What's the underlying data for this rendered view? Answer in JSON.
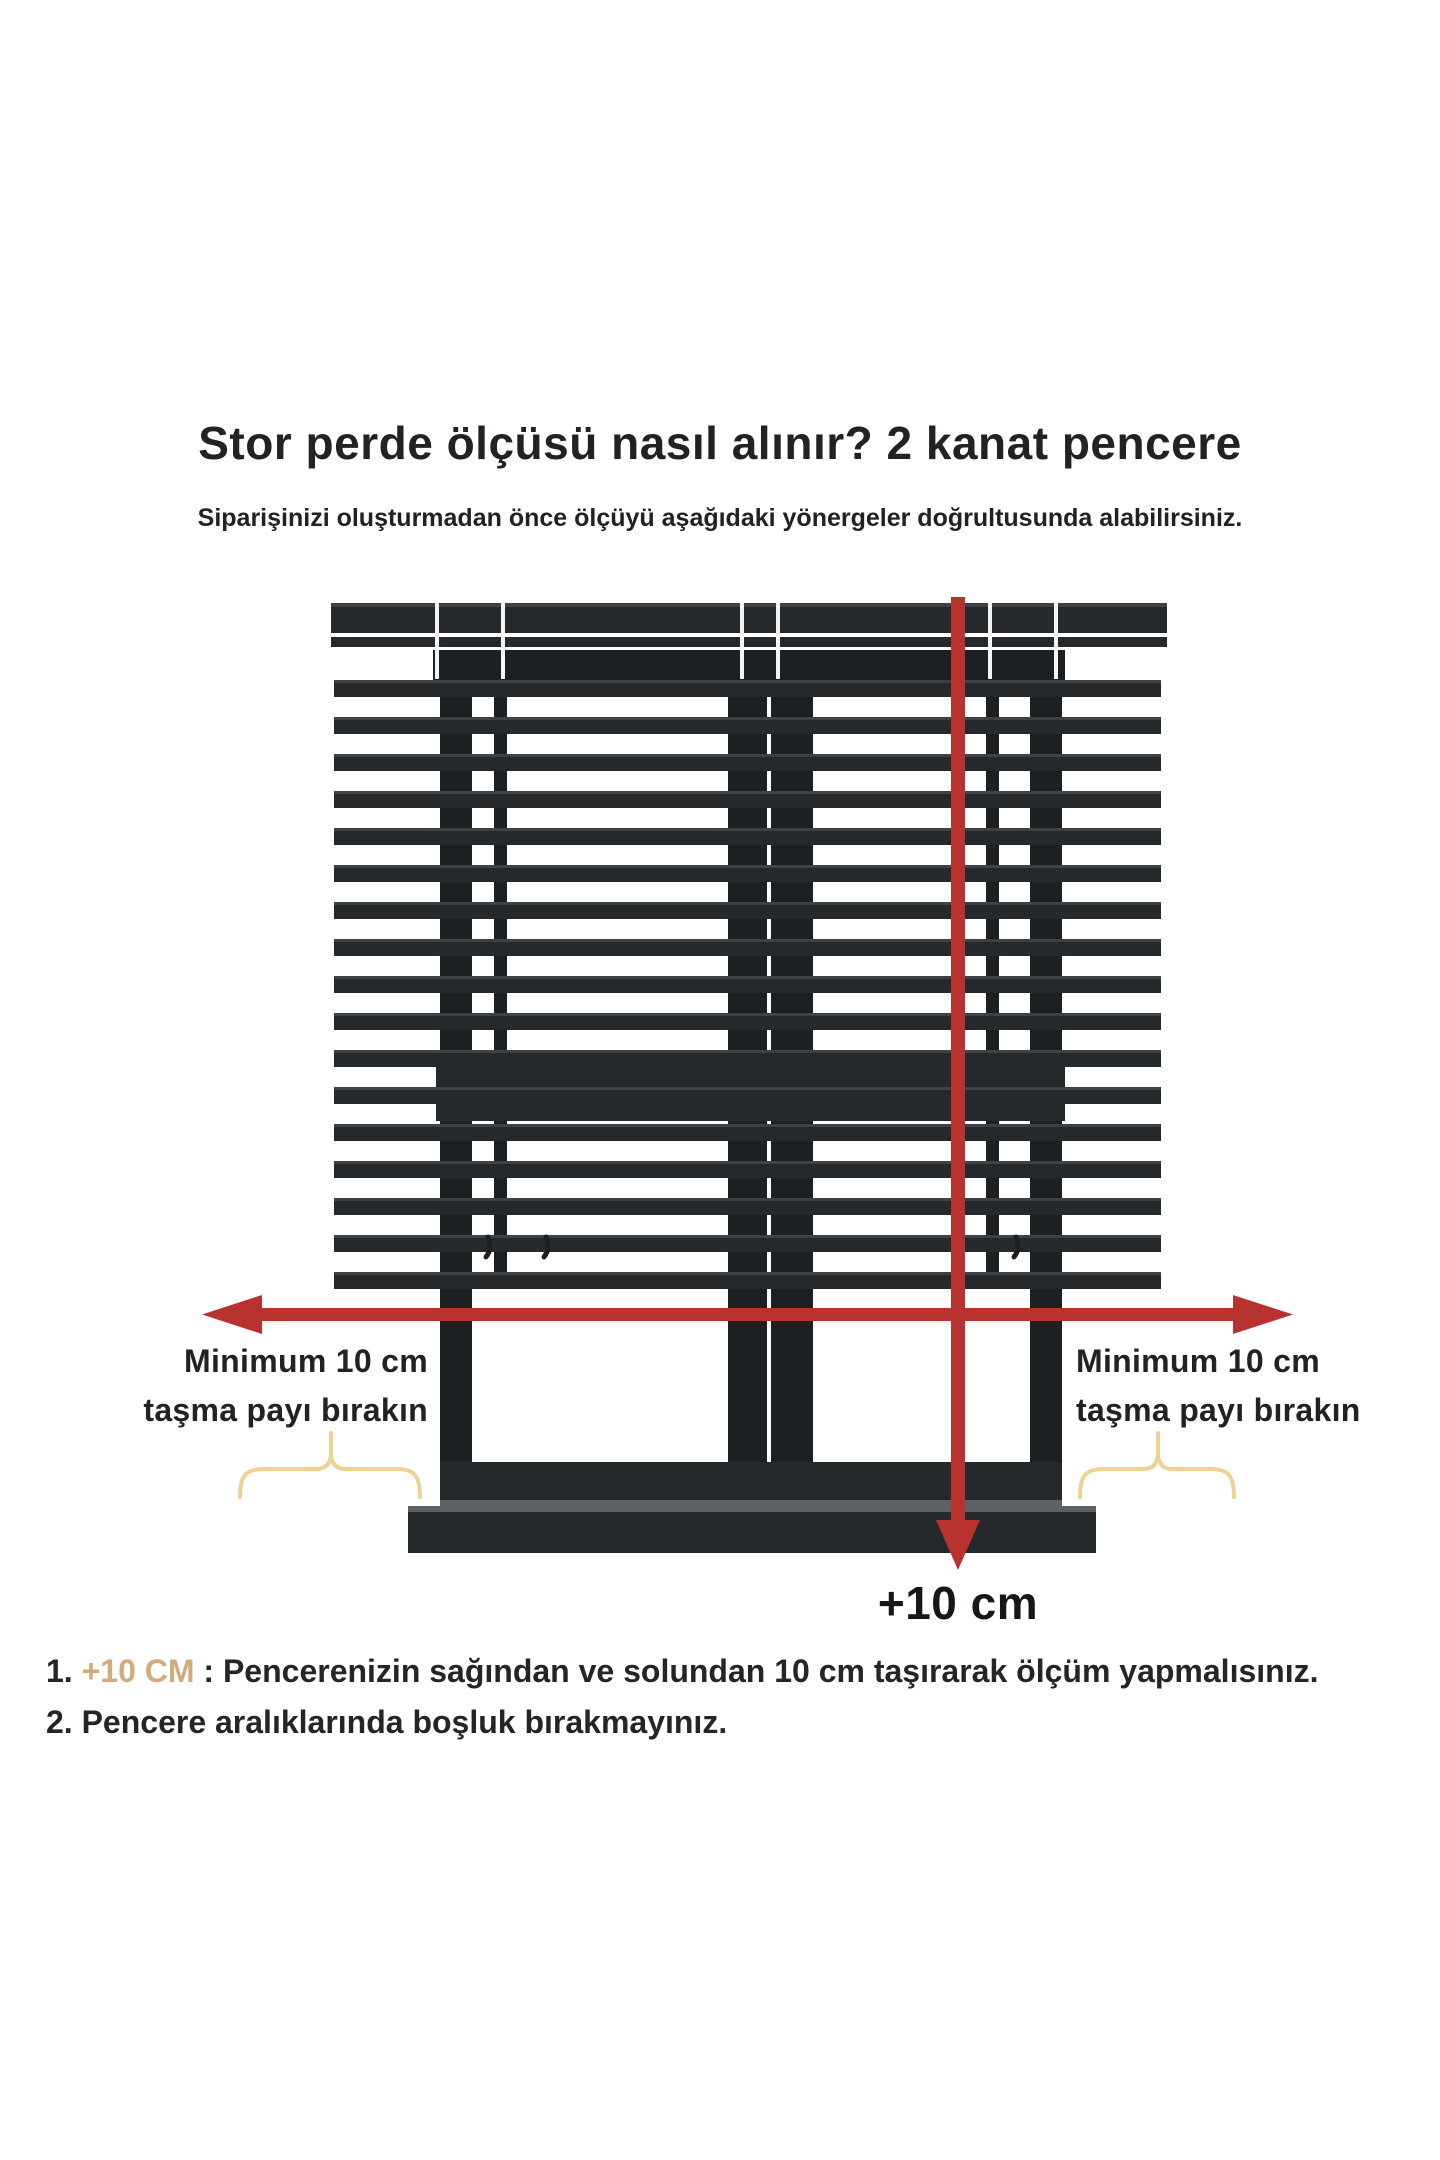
{
  "header": {
    "title": "Stor perde ölçüsü nasıl alınır? 2 kanat pencere",
    "subtitle": "Siparişinizi oluşturmadan önce ölçüyü aşağıdaki yönergeler doğrultusunda alabilirsiniz."
  },
  "diagram": {
    "type": "measurement-instruction-diagram",
    "subject": "Venetian blind covering a 2-casement window with width and height measuring arrows",
    "left_overhang_label": [
      "Minimum 10 cm",
      "taşma payı bırakın"
    ],
    "right_overhang_label": [
      "Minimum 10 cm",
      "taşma payı bırakın"
    ],
    "vertical_arrow_label": "+10 cm",
    "slat_count": 17,
    "colors": {
      "slat_dark": "#26292b",
      "frame_dark": "#1d2022",
      "arrow_red": "#b8322f",
      "brace_gold": "#ecd394",
      "note_highlight_gold": "#d0ab7e",
      "text_dark": "#202224"
    }
  },
  "notes": [
    {
      "number": "1.",
      "highlight": "+10 CM",
      "separator": " : ",
      "text": "Pencerenizin sağından ve solundan 10 cm taşırarak ölçüm yapmalısınız."
    },
    {
      "number": "2.",
      "highlight": "",
      "separator": "",
      "text": "Pencere aralıklarında boşluk bırakmayınız."
    }
  ]
}
